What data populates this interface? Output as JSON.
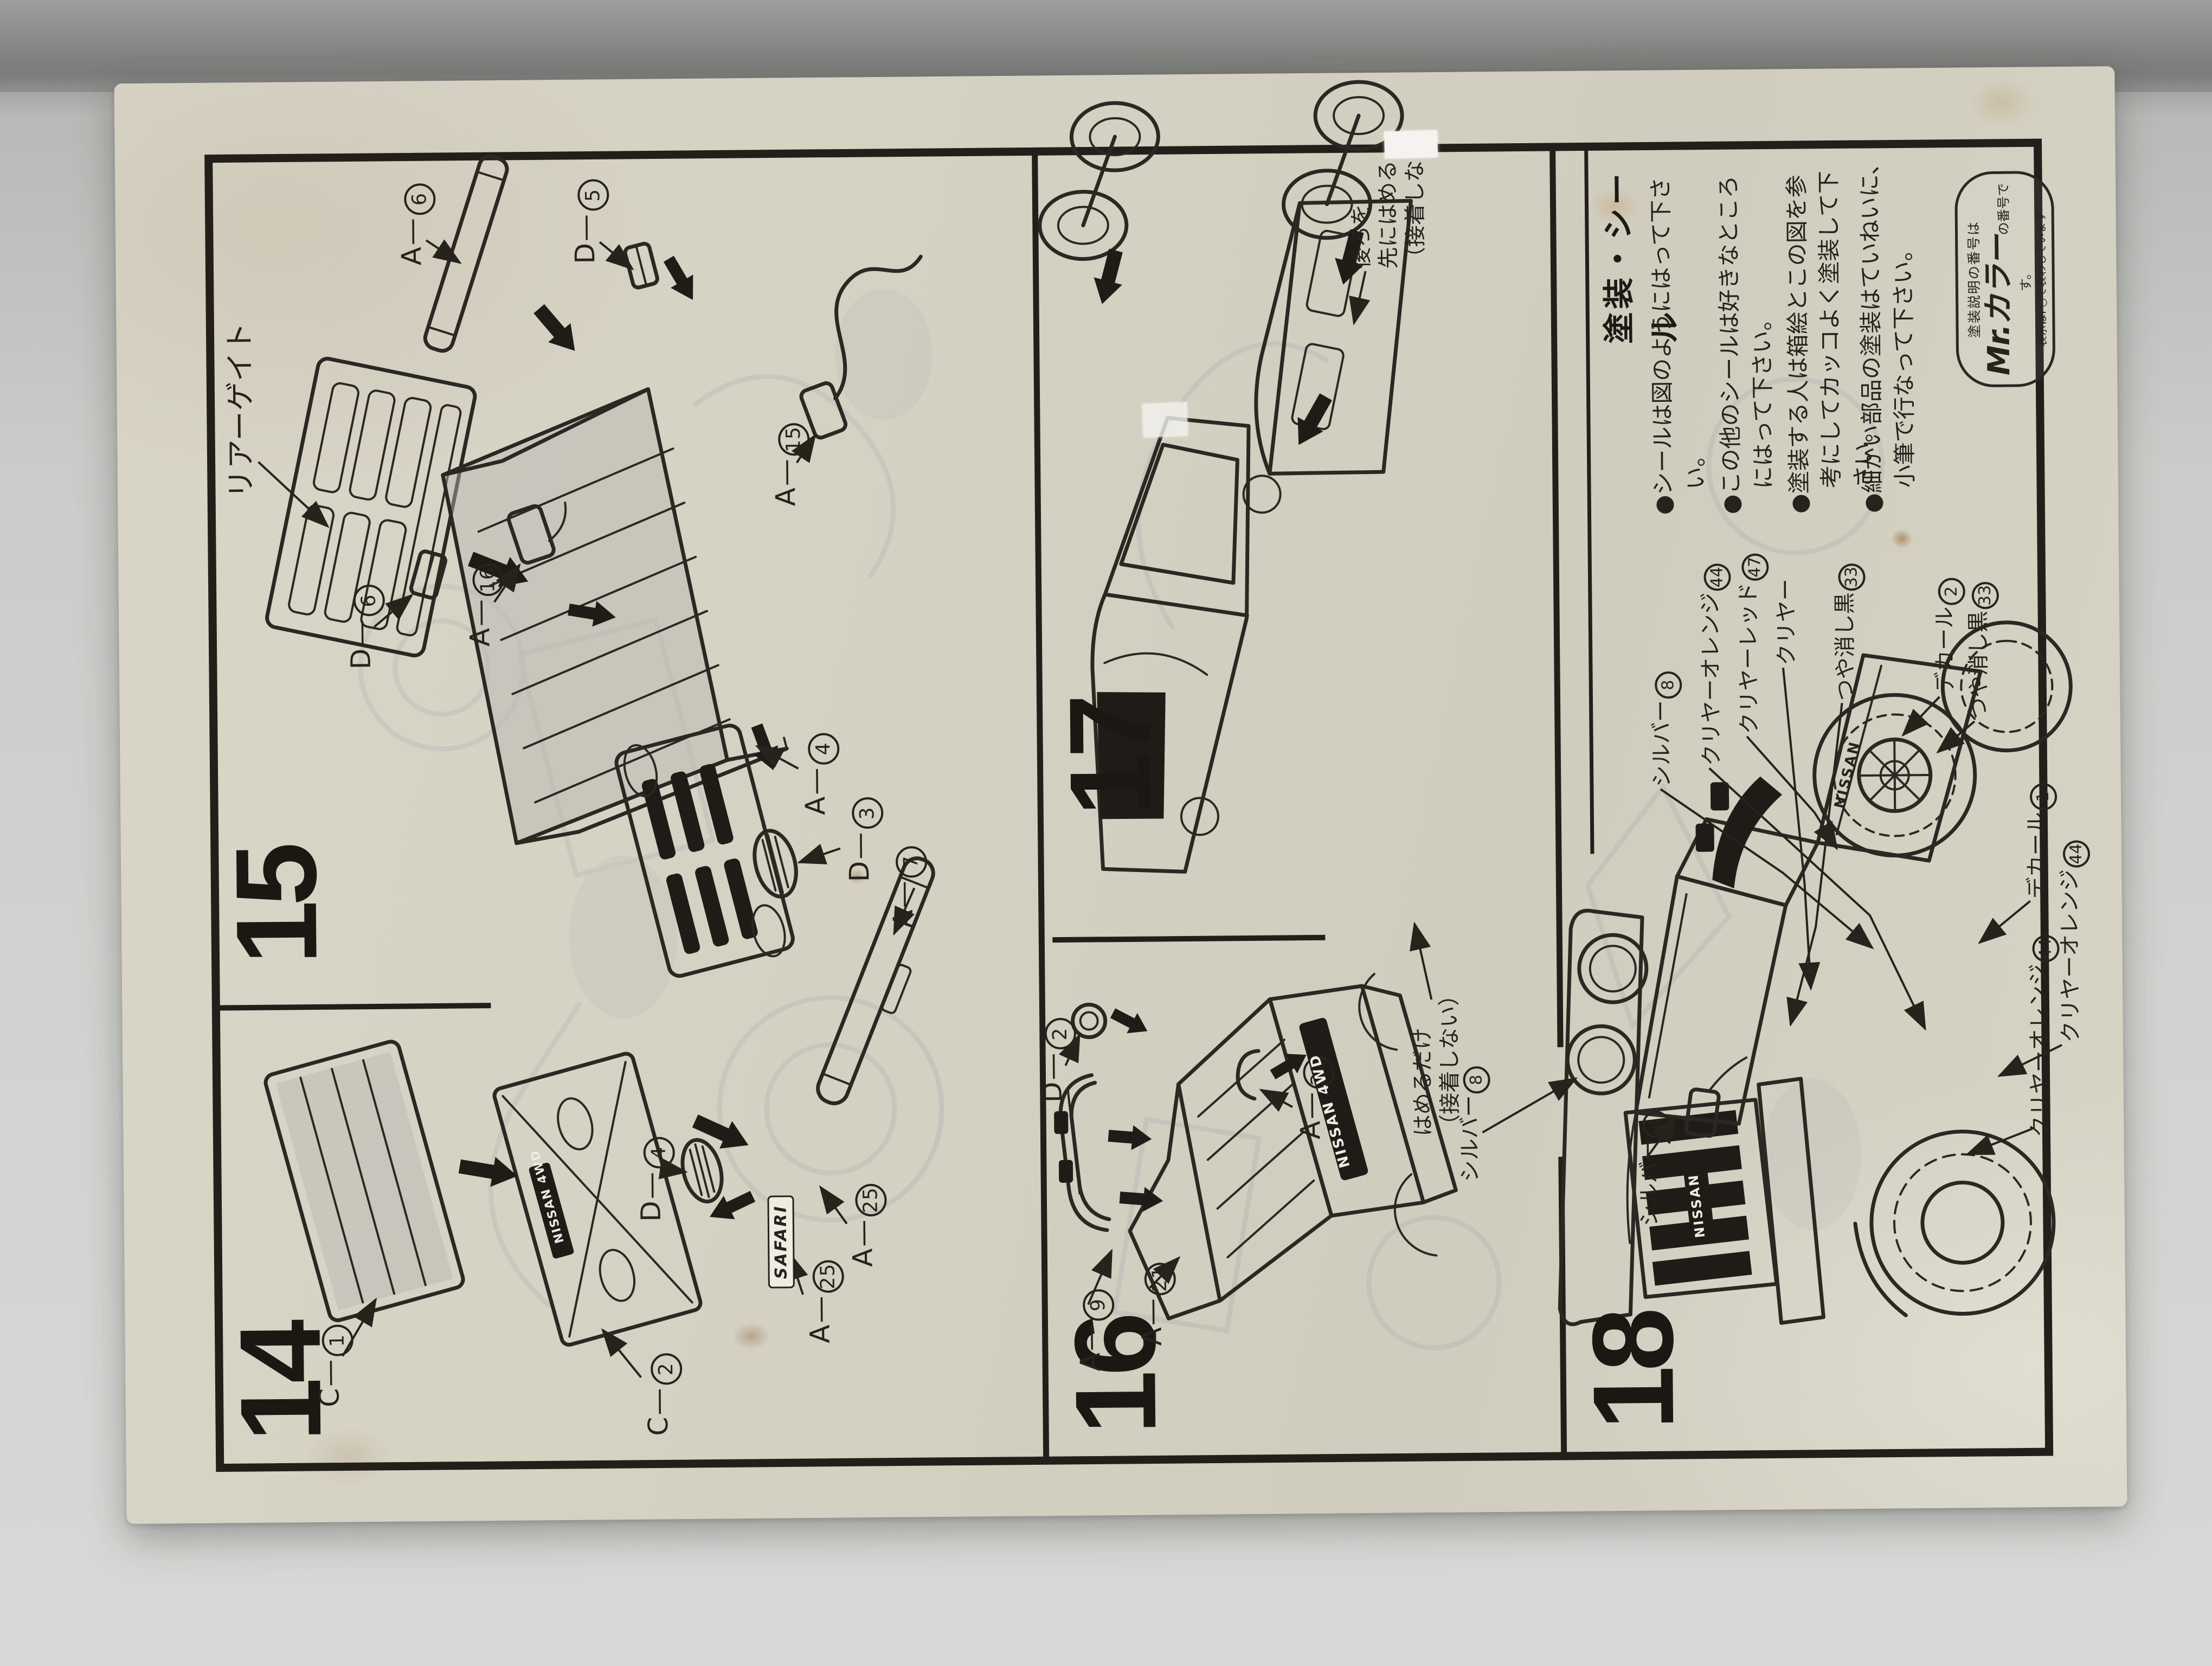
{
  "ui": {
    "sep": "—",
    "bullet": "●"
  },
  "steps": {
    "s14": "14",
    "s15": "15",
    "s16": "16",
    "s17": "17",
    "s18": "18"
  },
  "panel15": {
    "caption": "リアーゲイト",
    "labels": [
      {
        "letter": "A",
        "num": "6"
      },
      {
        "letter": "D",
        "num": "5"
      },
      {
        "letter": "D",
        "num": "6"
      },
      {
        "letter": "A",
        "num": "16"
      },
      {
        "letter": "A",
        "num": "15"
      },
      {
        "letter": "A",
        "num": "4"
      },
      {
        "letter": "D",
        "num": "3"
      },
      {
        "letter": "D",
        "num": "4"
      },
      {
        "letter": "A",
        "num": "7"
      }
    ]
  },
  "panel14": {
    "badge": "SAFARI",
    "panel_badge": "NISSAN 4WD",
    "labels": [
      {
        "letter": "C",
        "num": "1"
      },
      {
        "letter": "C",
        "num": "2"
      },
      {
        "letter": "A",
        "num": "25"
      },
      {
        "letter": "A",
        "num": "25"
      }
    ]
  },
  "panel16": {
    "tailgate_badge": "NISSAN 4WD",
    "labels": [
      {
        "letter": "D",
        "num": "2"
      },
      {
        "letter": "A",
        "num": "9"
      },
      {
        "letter": "A",
        "num": "21"
      },
      {
        "letter": "A",
        "num": "22"
      }
    ]
  },
  "panel17": {
    "note_fit_rear": [
      "後ろを",
      "先にはめる",
      "（接着しない）"
    ],
    "note_snap": [
      "はめるだけ",
      "（接着しない）"
    ]
  },
  "panel18": {
    "grille_badge": "NISSAN",
    "bed_badge": "NISSAN",
    "paint_list": [
      {
        "name": "シルバー",
        "num": "8"
      },
      {
        "name": "クリヤーオレンジ",
        "num": "44"
      },
      {
        "name": "クリヤーレッド",
        "num": "47"
      },
      {
        "name": "クリヤー",
        "num": ""
      },
      {
        "name": "つや消し黒",
        "num": "33"
      }
    ],
    "callouts": [
      {
        "name": "シルバー",
        "num": "8"
      },
      {
        "name": "シルバー",
        "num": "8"
      },
      {
        "name": "デカール",
        "num": "2"
      },
      {
        "name": "つや消し黒",
        "num": "33"
      },
      {
        "name": "デカール",
        "num": "1"
      },
      {
        "name": "クリヤーオレンジ",
        "num": "44"
      },
      {
        "name": "クリヤーオレンジ",
        "num": "44"
      }
    ]
  },
  "notes": {
    "heading": "塗装・シール",
    "bullets": [
      "シールは図のようにはって下さい。",
      "この他のシールは好きなところにはって下さい。",
      "塗装する人は箱絵とこの図を参考にしてカッコよく塗装して下さい。",
      "細かい部品の塗装はていねいに、小筆で行なって下さい。"
    ],
    "mr_color": {
      "pre": "塗装説明の番号は",
      "brand": "Mr.カラー",
      "post": "の番号です。",
      "small": "表示はP○で表わしています"
    }
  }
}
